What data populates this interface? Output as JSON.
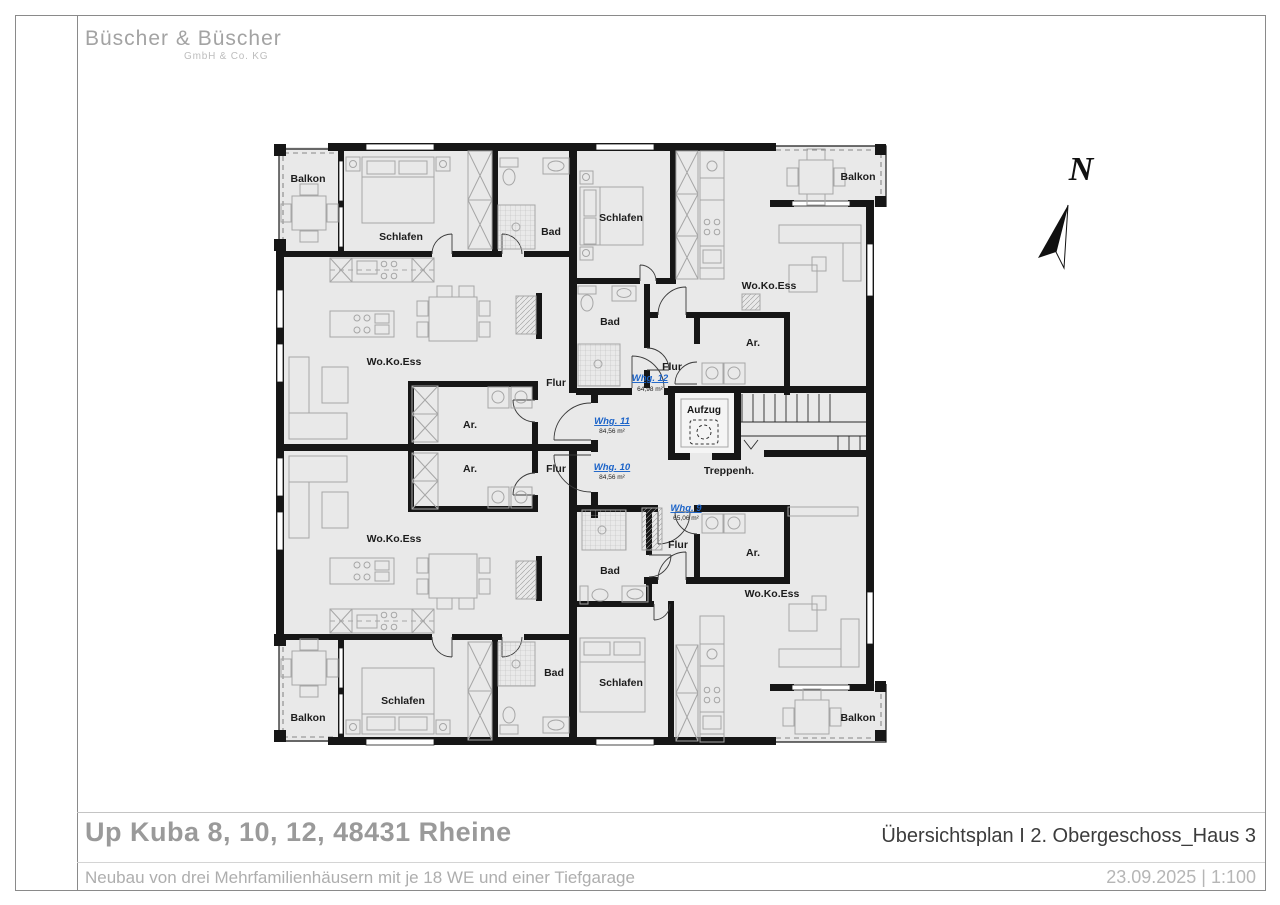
{
  "logo": {
    "company": "Büscher & Büscher",
    "suffix": "GmbH & Co. KG"
  },
  "title_block": {
    "project_title": "Up Kuba 8, 10, 12, 48431 Rheine",
    "project_subtitle": "Neubau von drei Mehrfamilienhäusern mit je 18 WE und einer Tiefgarage",
    "plan_title": "Übersichtsplan I 2. Obergeschoss_Haus 3",
    "date_scale": "23.09.2025  |  1:100"
  },
  "compass": {
    "north_label": "N"
  },
  "plan": {
    "rooms": {
      "balkon": "Balkon",
      "schlafen": "Schlafen",
      "bad": "Bad",
      "wohnen": "Wo.Ko.Ess",
      "flur": "Flur",
      "abstellraum": "Ar.",
      "aufzug": "Aufzug",
      "treppenhaus": "Treppenh."
    },
    "units": [
      {
        "name": "Whg. 12",
        "area": "64,98 m²"
      },
      {
        "name": "Whg. 11",
        "area": "84,56 m²"
      },
      {
        "name": "Whg. 10",
        "area": "84,56 m²"
      },
      {
        "name": "Whg. 9",
        "area": "65,06 m²"
      }
    ],
    "colors": {
      "wall": "#161616",
      "floor": "#e9e9e9",
      "furniture": "#a6a6a6",
      "unit_link": "#1b63c8"
    }
  }
}
